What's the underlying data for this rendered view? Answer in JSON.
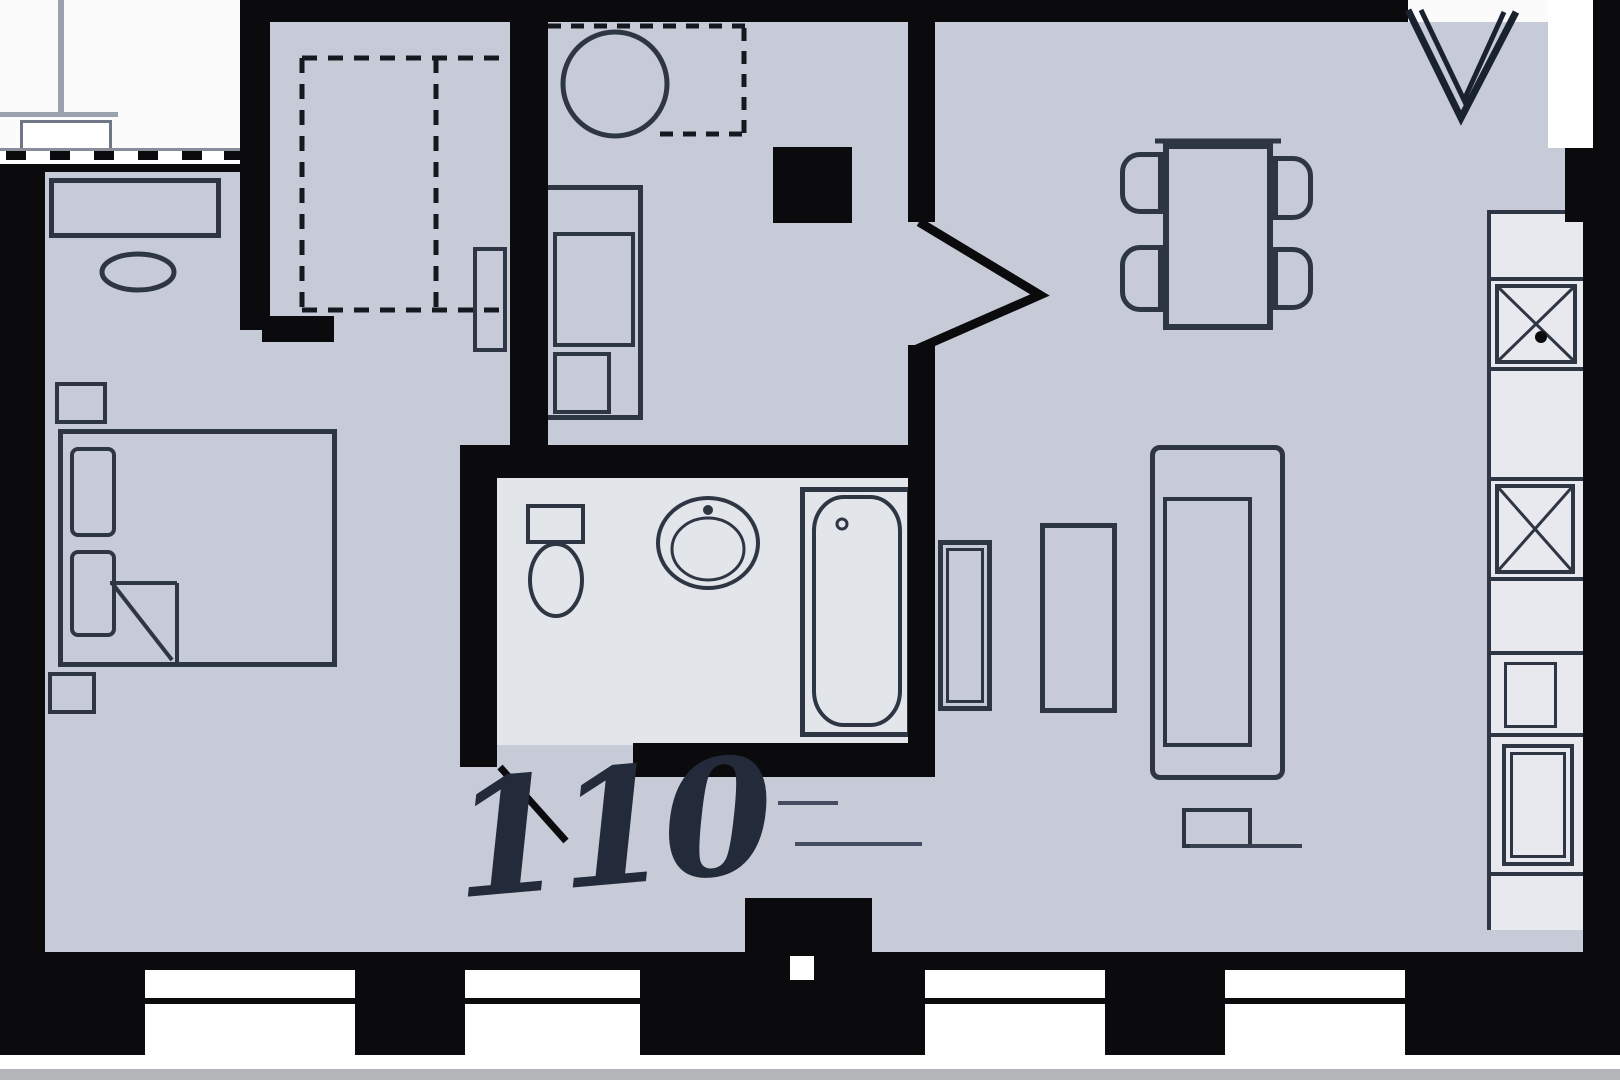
{
  "floorplan": {
    "room_number": "110",
    "colors": {
      "wall": "#0b0b0d",
      "floor": "#c6cbd7",
      "bathroom_floor": "#e2e5ea",
      "counter": "#e7e9ee",
      "outside": "#fbfbfc",
      "line": "#2e3644",
      "faint_line": "#9aa2b0",
      "window_white": "#ffffff",
      "outside_strip": "#b4b6ba",
      "label": "#232a3a"
    }
  }
}
